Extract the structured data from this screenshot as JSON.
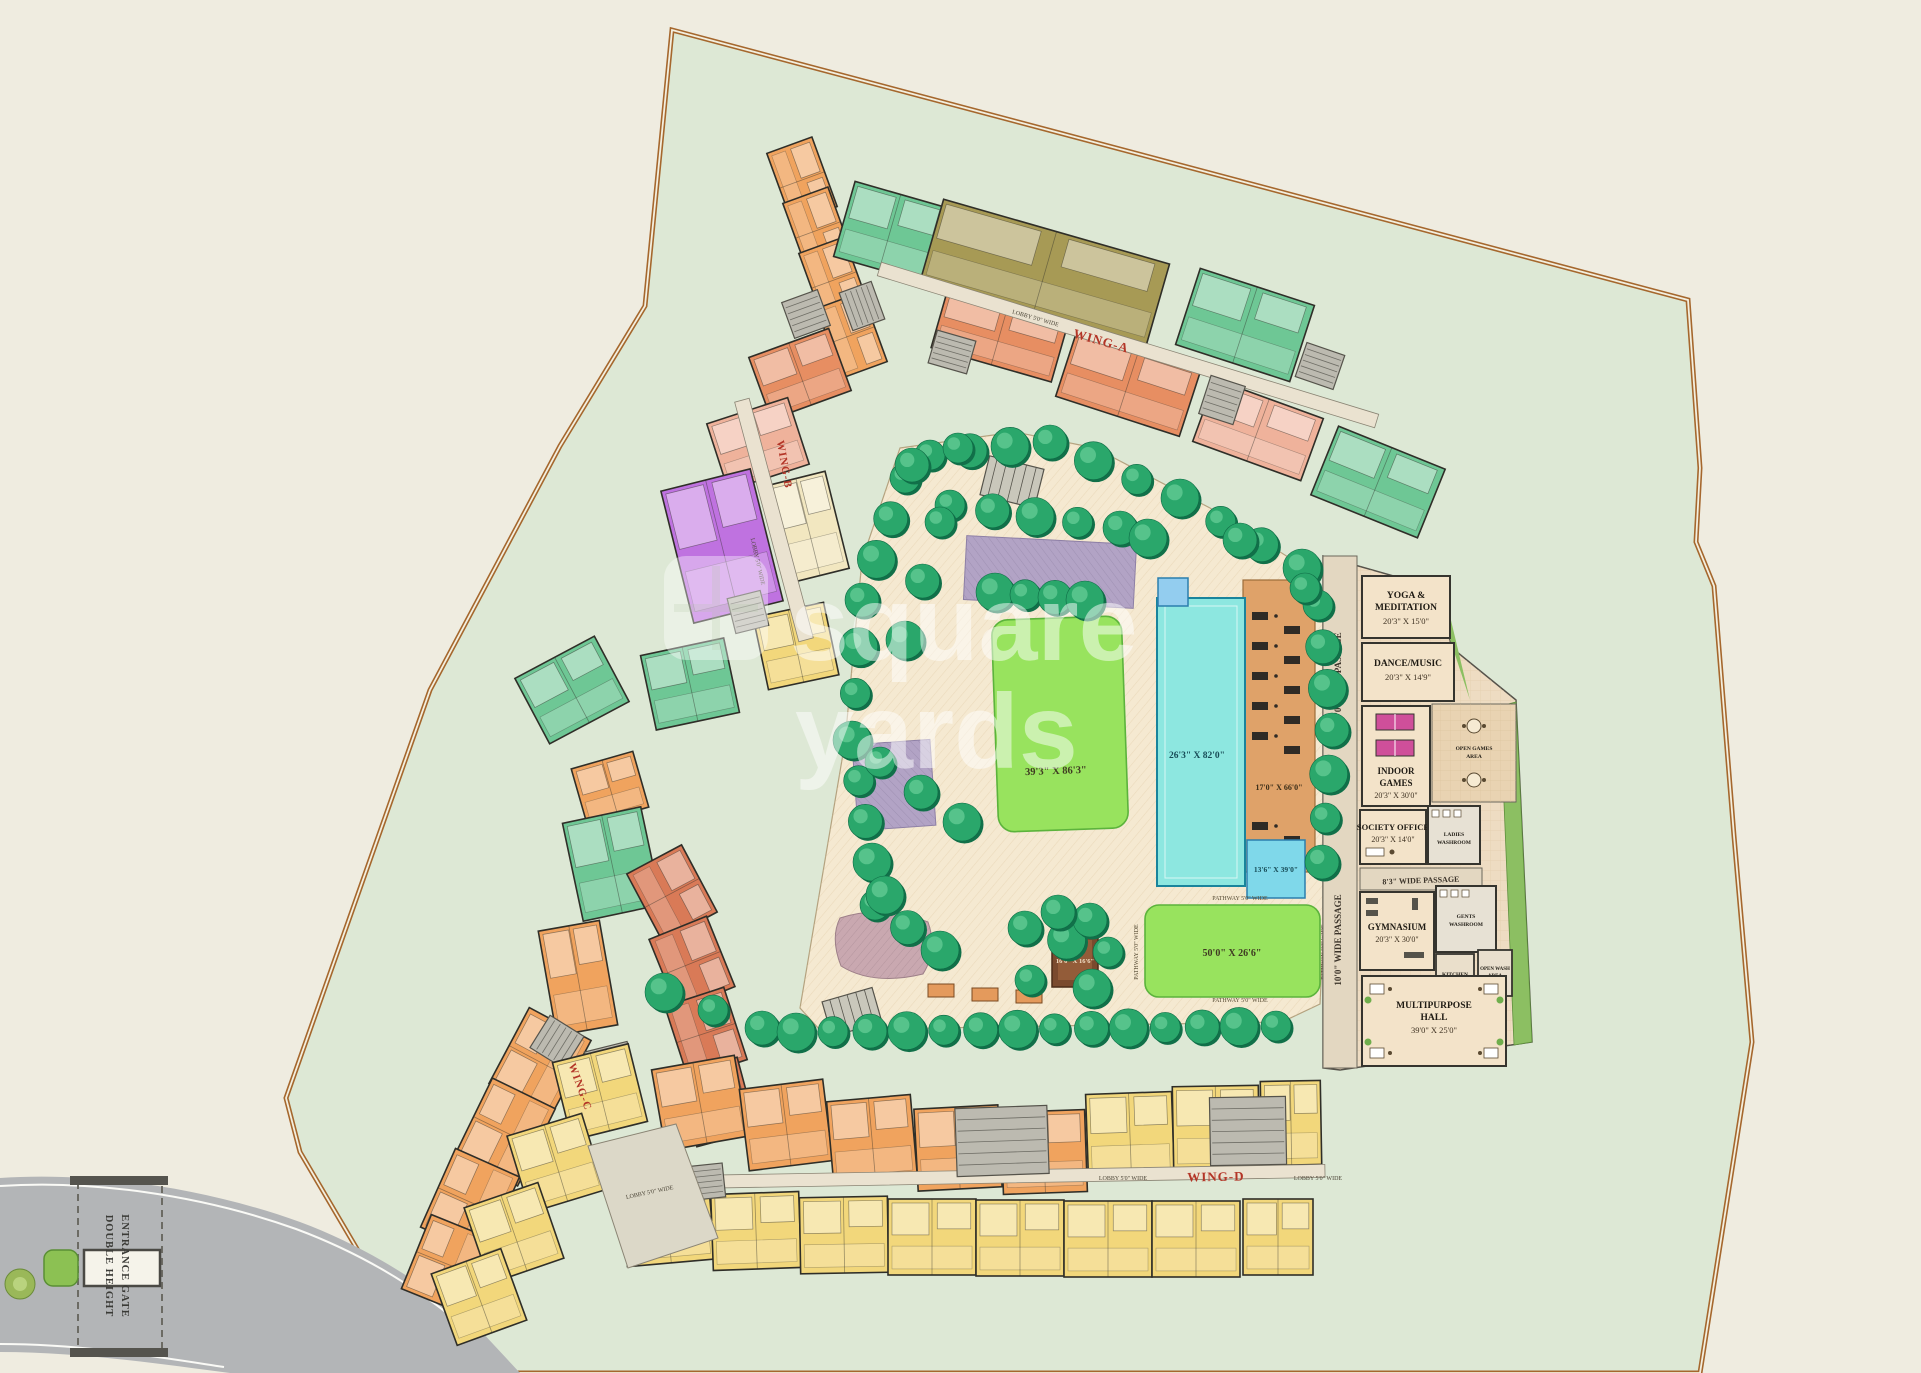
{
  "site": {
    "watermark_line1": "square",
    "watermark_line2": "yards",
    "entrance_line1": "DOUBLE HEIGHT",
    "entrance_line2": "ENTRANCE GATE"
  },
  "wings": {
    "a": "WING-A",
    "b": "WING-B",
    "c": "WING-C",
    "d": "WING-D"
  },
  "corridors": {
    "lobby": "LOBBY 5'0\" WIDE"
  },
  "passages": {
    "vertical": "10'0\" WIDE PASSAGE",
    "horizontal": "8'3\" WIDE PASSAGE"
  },
  "garden": {
    "lawn_main": "39'3\" X 86'3\"",
    "pool": "26'3\" X 82'0\"",
    "pool_deck": "17'0\" X 66'0\"",
    "kids_pool": "13'6\" X 39'0\"",
    "lawn_south": "50'0\" X 26'6\"",
    "pavilion": "16'0\" X 16'6\"",
    "pathway": "PATHWAY 5'0\" WIDE"
  },
  "amenities": {
    "yoga": {
      "name1": "YOGA &",
      "name2": "MEDITATION",
      "dim": "20'3\" X 15'0\""
    },
    "dance": {
      "name": "DANCE/MUSIC",
      "dim": "20'3\" X 14'9\""
    },
    "indoor_games": {
      "name1": "INDOOR",
      "name2": "GAMES",
      "dim": "20'3\" X 30'0\""
    },
    "open_games": {
      "name1": "OPEN GAMES",
      "name2": "AREA"
    },
    "society_office": {
      "name": "SOCIETY OFFICE",
      "dim": "20'3\" X 14'0\""
    },
    "ladies_washroom": {
      "name1": "LADIES",
      "name2": "WASHROOM"
    },
    "gents_washroom": {
      "name1": "GENTS",
      "name2": "WASHROOM"
    },
    "kitchen": {
      "name": "KITCHEN"
    },
    "open_wash": {
      "name1": "OPEN WASH",
      "name2": "AREA"
    },
    "gym": {
      "name": "GYMNASIUM",
      "dim": "20'3\" X 30'0\""
    },
    "hall": {
      "name1": "MULTIPURPOSE",
      "name2": "HALL",
      "dim": "39'0\" X 25'0\""
    }
  }
}
